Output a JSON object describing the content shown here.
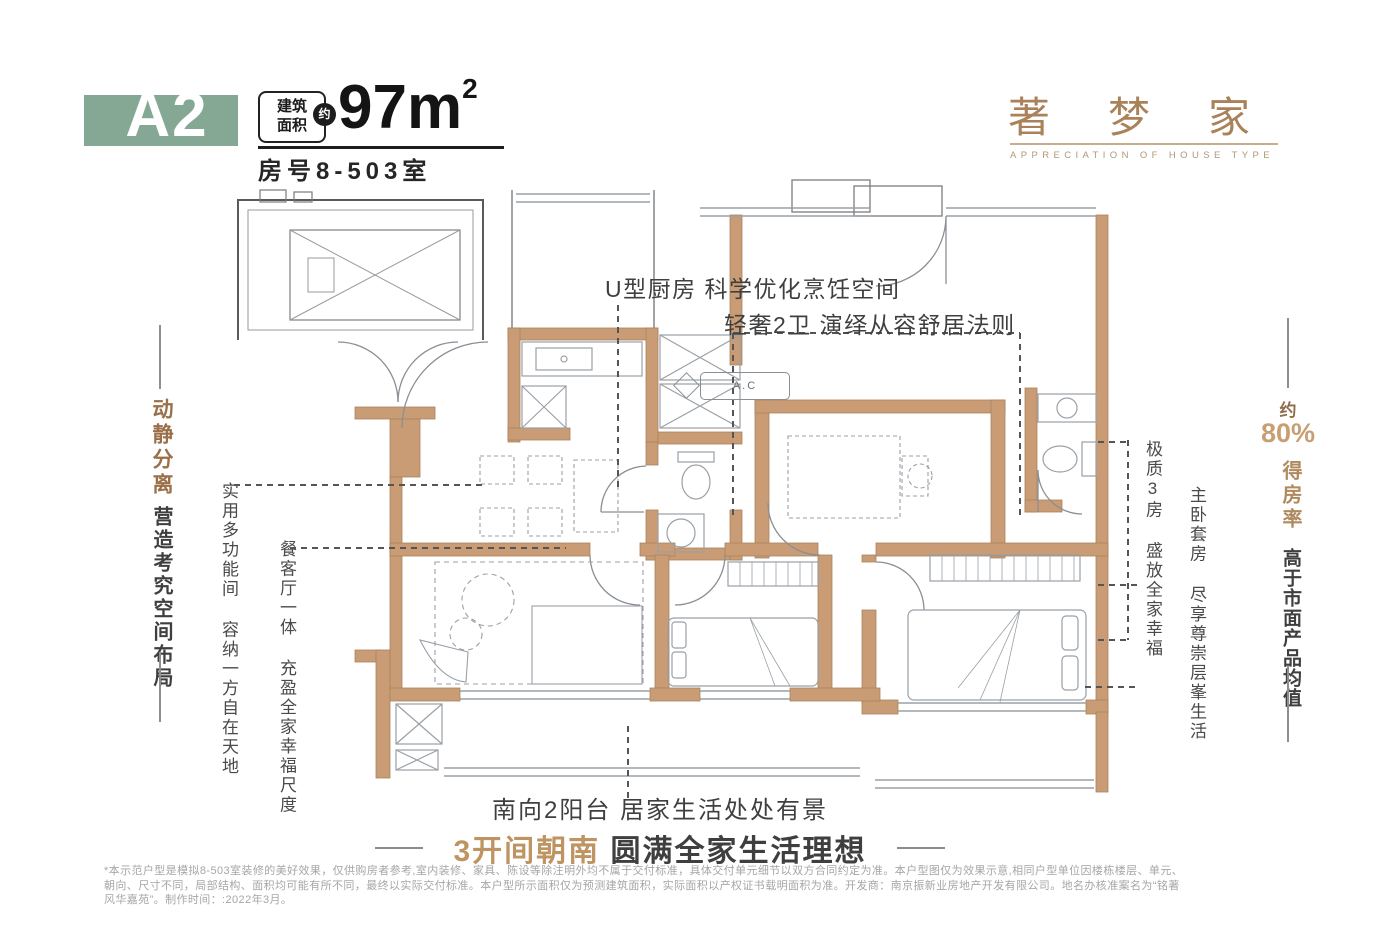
{
  "colors": {
    "accent_green": "#85A894",
    "bronze": "#A9825A",
    "bronze_light": "#C89F72",
    "dark_text": "#3F3F3F",
    "wall_tan": "#C99C75",
    "disclaimer_gray": "#A6A6A6"
  },
  "header": {
    "unit_code": "A2",
    "area_badge_line1": "建筑",
    "area_badge_line2": "面积",
    "area_badge_circle": "约",
    "area_value": "97m",
    "area_unit_sup": "2",
    "room_number": "房号8-503室"
  },
  "brand": {
    "title": "著梦家",
    "subtitle": "APPRECIATION OF HOUSE TYPE"
  },
  "left_rail": {
    "headline": "动静分离",
    "statement": "营造考究空间布局",
    "note_multifunction": "实用多功能间 容纳一方自在天地",
    "note_dining": "餐客厅一体 充盈全家幸福尺度"
  },
  "right_rail": {
    "note_rooms": "极质3房 盛放全家幸福",
    "note_master": "主卧套房 尽享尊崇层峯生活",
    "approx": "约",
    "rate_value": "80%",
    "rate_label": "得房率",
    "statement": "高于市面产品均值"
  },
  "plan_annotations": {
    "kitchen": "U型厨房 科学优化烹饪空间",
    "bath": "轻奢2卫 演绎从容舒居法则",
    "balcony": "南向2阳台 居家生活处处有景",
    "ac_unit": "A.C"
  },
  "tagline": {
    "highlight": "3开间朝南",
    "rest": "圆满全家生活理想"
  },
  "disclaimer": {
    "line1": "*本示范户型是模拟8-503室装修的美好效果，仅供购房者参考,室内装修、家具、陈设等除注明外均不属于交付标准，具体交付单元细节以双方合同约定为准。本户型图仅为效果示意,相同户型单位因楼栋楼层、单元、",
    "line2": "朝向、尺寸不同，局部结构、面积均可能有所不同，最终以实际交付标准。本户型所示面积仅为预测建筑面积，实际面积以产权证书载明面积为准。开发商：南京振新业房地产开发有限公司。地名办核准案名为“铭著",
    "line3": "风华嘉苑”。制作时间：:2022年3月。"
  }
}
